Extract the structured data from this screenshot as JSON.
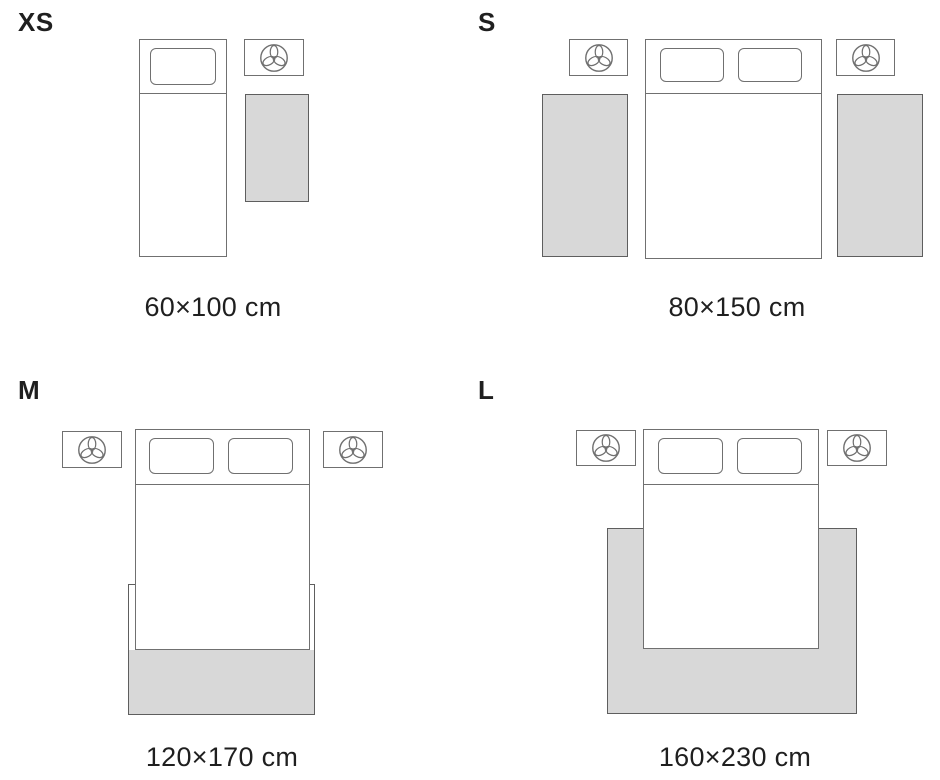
{
  "colors": {
    "outline": "#707070",
    "rug_fill": "#D8D8D8",
    "rug_outline": "#5E5E5E",
    "text": "#1F1F1F",
    "background": "#FFFFFF"
  },
  "icons": {
    "nightstand_icon": "lamp-icon"
  },
  "sections": [
    {
      "id": "xs",
      "label": "XS",
      "dimension": "60×100 cm"
    },
    {
      "id": "s",
      "label": "S",
      "dimension": "80×150 cm"
    },
    {
      "id": "m",
      "label": "M",
      "dimension": "120×170 cm"
    },
    {
      "id": "l",
      "label": "L",
      "dimension": "160×230 cm"
    }
  ]
}
